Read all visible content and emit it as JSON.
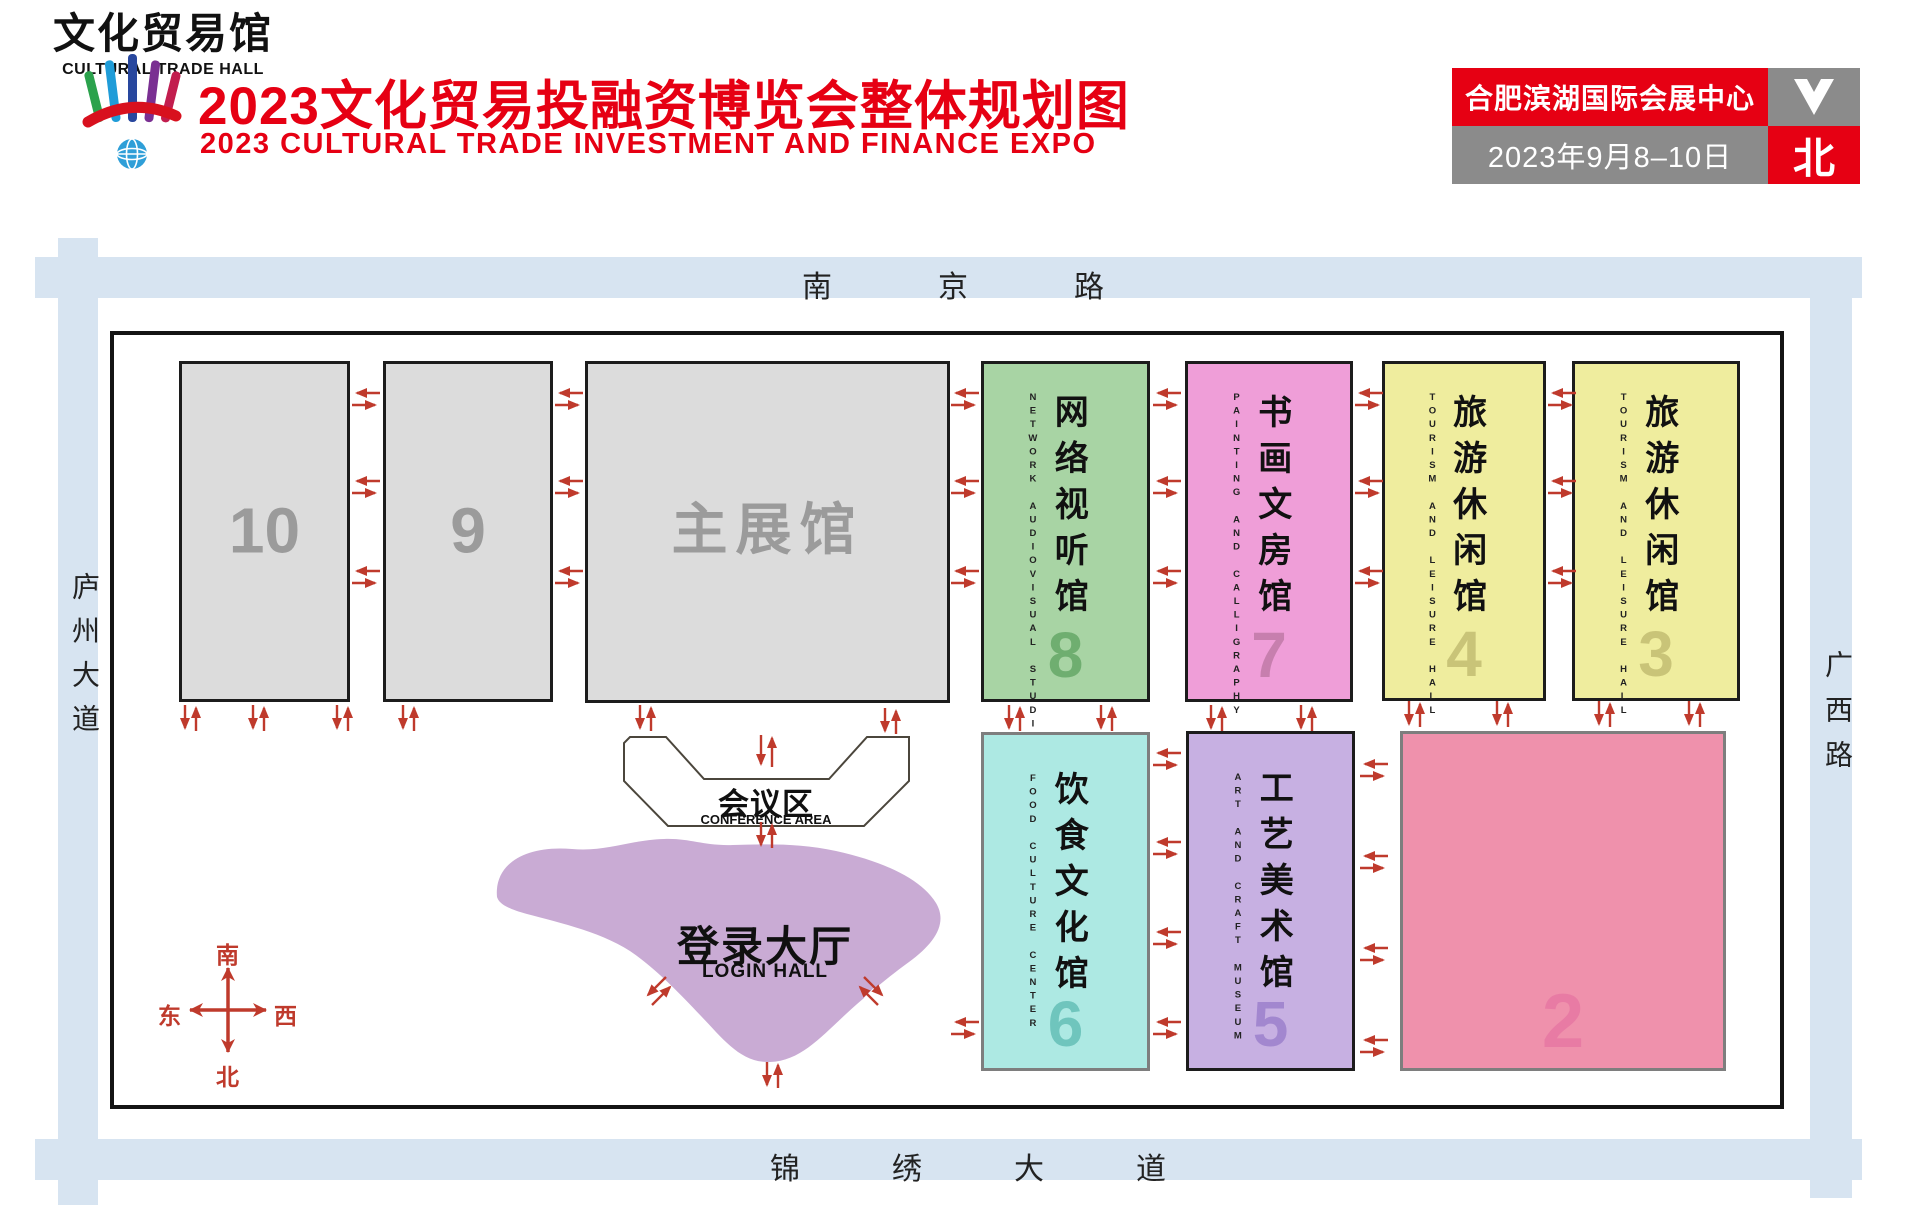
{
  "header": {
    "title_cn": "2023文化贸易投融资博览会整体规划图",
    "title_en": "2023 CULTURAL TRADE INVESTMENT AND FINANCE EXPO",
    "info": {
      "venue": "合肥滨湖国际会展中心",
      "dates": "2023年9月8–10日",
      "north_label": "北"
    }
  },
  "roads": {
    "north": "南京路",
    "south": "锦绣大道",
    "west": "庐州大道",
    "east": "广西路"
  },
  "compass": {
    "south": "南",
    "north": "北",
    "east": "东",
    "west": "西"
  },
  "halls": {
    "hall10": {
      "number": "10"
    },
    "hall9": {
      "number": "9"
    },
    "main": {
      "name_cn": "主展馆"
    },
    "hall8": {
      "number": "8",
      "name_cn": "网络视听馆",
      "name_en": "NETWORK AUDIOVISUAL STUDIO"
    },
    "hall7": {
      "number": "7",
      "name_cn": "书画文房馆",
      "name_en": "PAINTING AND CALLIGRAPHY LIBRARY"
    },
    "hall4": {
      "number": "4",
      "name_cn": "旅游休闲馆",
      "name_en": "TOURISM AND LEISURE HALL"
    },
    "hall3": {
      "number": "3",
      "name_cn": "旅游休闲馆",
      "name_en": "TOURISM AND LEISURE HALL"
    },
    "hall6": {
      "number": "6",
      "name_cn": "饮食文化馆",
      "name_en": "FOOD CULTURE CENTER"
    },
    "hall5": {
      "number": "5",
      "name_cn": "工艺美术馆",
      "name_en": "ART AND CRAFT MUSEUM"
    },
    "hall2": {
      "number": "2",
      "name_cn": "文化贸易馆",
      "name_en": "CULTURAL TRADE HALL"
    }
  },
  "areas": {
    "conference": {
      "name_cn": "会议区",
      "name_en": "CONFERENCE AREA"
    },
    "login": {
      "name_cn": "登录大厅",
      "name_en": "LOGIN HALL"
    }
  },
  "colors": {
    "accent_red": "#e60013",
    "arrow_red": "#bf3a2c",
    "road_blue": "#d7e4f1",
    "hall_gray": "#dcdcdc",
    "hall8_green": "#a8d4a4",
    "hall7_pink": "#ef9ed8",
    "hall43_yellow": "#efed9e",
    "hall6_cyan": "#ade9e3",
    "hall5_purple": "#c7b0e2",
    "hall2_rose": "#ef91ac",
    "login_purple": "#c9abd4",
    "info_gray": "#8b8b8b"
  }
}
